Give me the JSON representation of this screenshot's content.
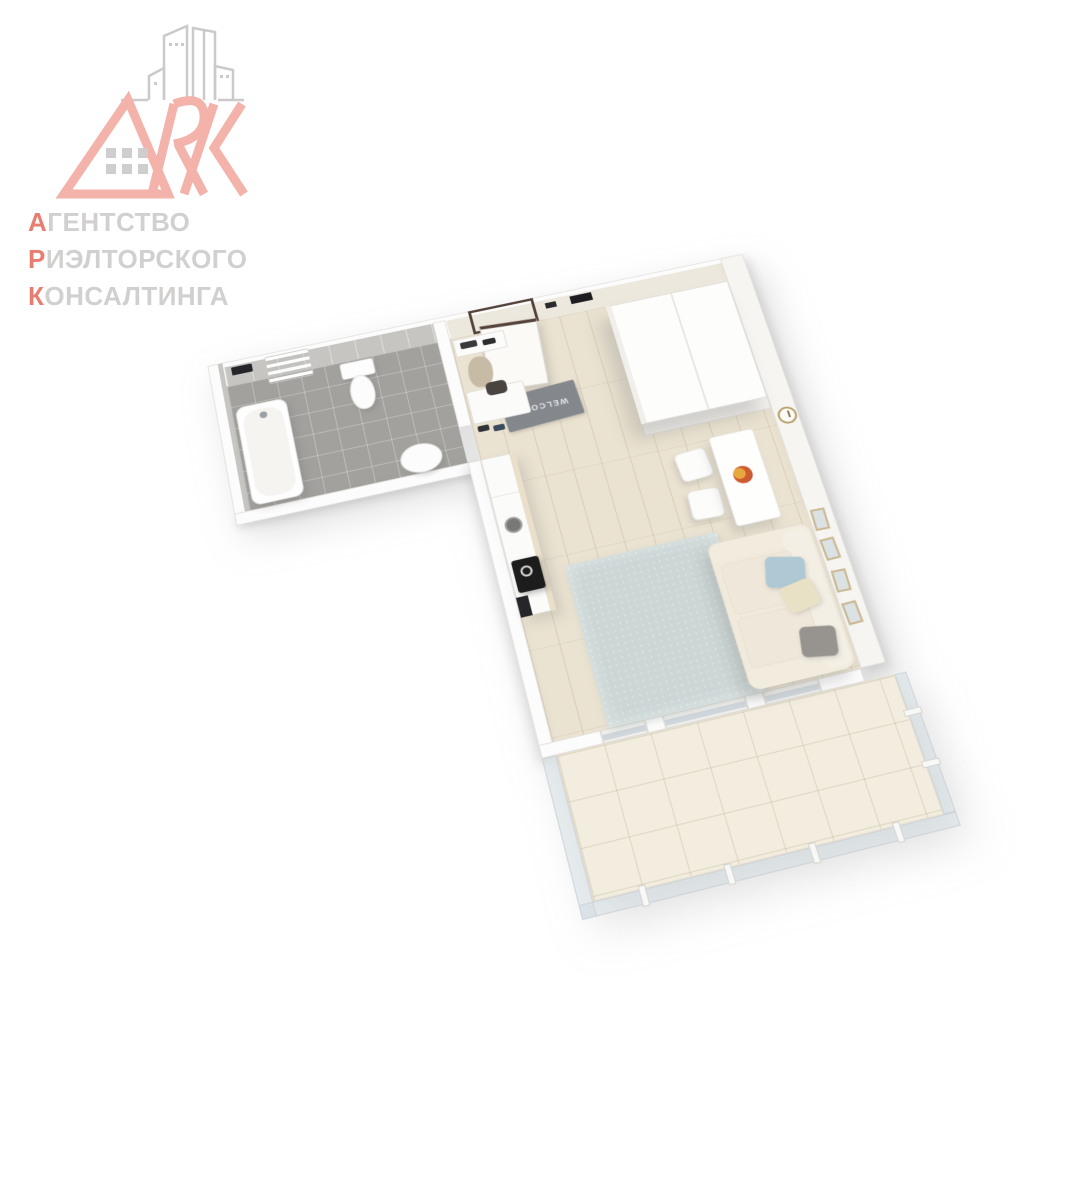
{
  "logo": {
    "monogram": "ARK",
    "lines": [
      {
        "first": "А",
        "rest": "ГЕНТСТВО"
      },
      {
        "first": "Р",
        "rest": "ИЭЛТОРСКОГО"
      },
      {
        "first": "К",
        "rest": "ОНСАЛТИНГА"
      }
    ]
  },
  "floorplan": {
    "type": "3d-apartment-render",
    "welcome_mat_text": "WELCOME",
    "rooms": [
      "bathroom",
      "entry-hall",
      "living-room-with-kitchen",
      "balcony"
    ],
    "furniture": [
      "bathtub",
      "toilet",
      "bathroom-sink",
      "towel-rack",
      "entry-door",
      "welcome-mat",
      "coat-shelf",
      "coat",
      "shoe-bench",
      "bag",
      "shoes",
      "wardrobe",
      "kitchen-counter",
      "kitchen-sink",
      "cooktop",
      "dining-table",
      "chairs",
      "fruit-plate",
      "wall-clock",
      "picture-frames",
      "sofa",
      "pillows",
      "rug",
      "balcony-railing"
    ]
  },
  "colors": {
    "logo_accent": "#E87E72",
    "logo_letters": "#F3B2AA",
    "logo_gray": "#D2D0CF",
    "logo_buildings": "#CBC9C9",
    "wall": "#FCFCFC",
    "bath_wall_tile": "#C7C5C1",
    "hall_wall": "#EDE8DE",
    "wood_floor": "#EBE3D1",
    "bath_floor": "#A3A19E",
    "balcony_floor": "#F3EDDF",
    "rug": "#CBD6D5",
    "mat": "#84888D",
    "door_frame": "#54413A",
    "sofa": "#F0EADD",
    "pillow_blue": "#AFC9D4",
    "pillow_cream": "#E9E1C6",
    "pillow_gray": "#97948F",
    "counter_top": "#EADFCB",
    "cooktop": "#1C1C1C",
    "clock_rim": "#B49B62",
    "frame_wood": "#C9B68F"
  }
}
